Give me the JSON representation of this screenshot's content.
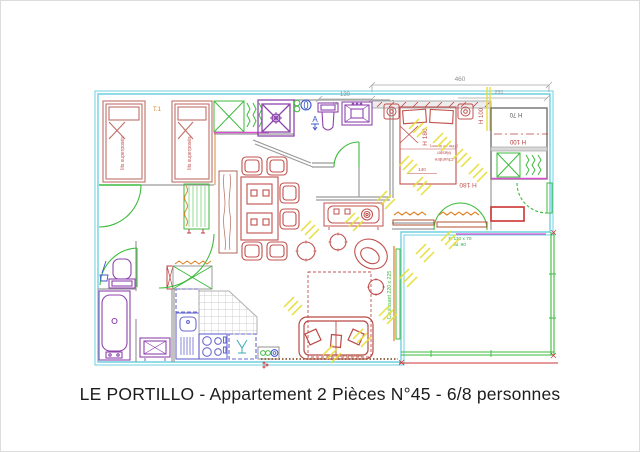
{
  "page": {
    "caption": "LE PORTILLO - Appartement 2 Pièces N°45 - 6/8 personnes"
  },
  "labels": {
    "unit_type": "T.1",
    "bunk": "lits superposés",
    "master_line1": "Chambre",
    "master_line2": "Master",
    "master_line3": "(Tête de lit mer)",
    "h180_bed": "H 180",
    "h180_label": "H 180",
    "dim140": "140",
    "h70": "H 70",
    "h100_shelf": "H 100",
    "h100_side": "H 100",
    "sliding_door": "Coulissant 220 x 225",
    "window_f": "F. 110 x 70",
    "window_al": "al. 90",
    "wall_note": "Mur bois en pin blanc",
    "marker_a": "A"
  },
  "dimensions": {
    "d460": "460",
    "d130": "130",
    "d231": "231",
    "d16": "16"
  },
  "plan_colors": {
    "outline_cyan": "#6fd1e0",
    "furniture_red": "#c0504d",
    "sanitary_purple": "#9444b8",
    "joinery_green": "#3dbb3d",
    "appliance_blue": "#6a6ad0",
    "hatch_yellow": "#e6df3e",
    "wall_gray": "#9a9a9a",
    "accent_orange": "#e08020",
    "accent_magenta": "#d84fd0"
  }
}
